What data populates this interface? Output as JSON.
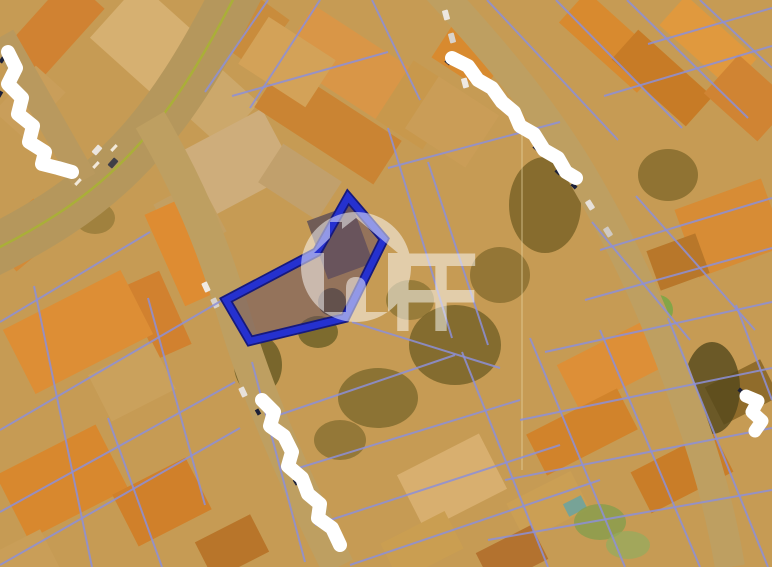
{
  "map": {
    "title": "aerial-cadastral-parcel-view",
    "canvas": {
      "width": 772,
      "height": 567
    },
    "colors": {
      "base": "#c49d58",
      "haze": "#e08a28",
      "parcel_line": "#8d90d8",
      "road": "#b79c64",
      "road_centerline": "#a6b23a",
      "highlight_stroke": "#2531cf",
      "highlight_underlay": "#16197d",
      "highlight_fill": "rgba(98,76,98,0.5)",
      "redaction": "#ffffff",
      "redaction_text_fragment": "#1c2038",
      "watermark": "#ffffff"
    },
    "roads": [
      {
        "name": "arterial-nw",
        "d": "M 240,-14 C 205,55 170,115 122,162 C 82,202 35,230 -14,254",
        "width": 50,
        "color": "#b29860",
        "centerline": true
      },
      {
        "name": "side-road-west",
        "d": "M 2,36 L 84,180",
        "width": 26,
        "color": "#b69a62",
        "centerline": false
      },
      {
        "name": "street-southwest",
        "d": "M 150,120 C 188,185 212,242 233,312 C 256,390 292,475 338,567",
        "width": 33,
        "color": "#bca166",
        "centerline": false
      },
      {
        "name": "street-northeast",
        "d": "M 438,-10 C 498,55 548,115 588,185 C 632,262 662,330 690,415 C 710,470 722,520 730,567",
        "width": 30,
        "color": "#bca166",
        "centerline": false
      }
    ],
    "road_marks": [
      [
        78,
        182
      ],
      [
        96,
        165
      ],
      [
        114,
        148
      ]
    ],
    "blocks": [
      [
        55,
        28,
        95,
        48,
        -48,
        "#cf8233"
      ],
      [
        30,
        102,
        62,
        40,
        -48,
        "#c8a05e"
      ],
      [
        150,
        42,
        74,
        95,
        -48,
        "#d6b377"
      ],
      [
        208,
        96,
        58,
        85,
        -48,
        "#cbaa70"
      ],
      [
        25,
        235,
        60,
        45,
        -40,
        "#d28a38"
      ],
      [
        238,
        162,
        92,
        72,
        -28,
        "#cdb082"
      ],
      [
        190,
        218,
        52,
        58,
        -28,
        "#c1a167"
      ],
      [
        184,
        252,
        42,
        100,
        -24,
        "#de8c33"
      ],
      [
        158,
        315,
        38,
        80,
        -24,
        "#d08130"
      ],
      [
        255,
        32,
        60,
        42,
        -54,
        "#c88c3e"
      ],
      [
        360,
        72,
        150,
        62,
        33,
        "#d9974a"
      ],
      [
        328,
        124,
        142,
        52,
        33,
        "#c98434"
      ],
      [
        287,
        62,
        80,
        56,
        33,
        "#d2a45c"
      ],
      [
        300,
        182,
        70,
        46,
        33,
        "#bfa271"
      ],
      [
        418,
        105,
        56,
        70,
        33,
        "#c6994f"
      ],
      [
        452,
        122,
        72,
        62,
        33,
        "#c99f5b"
      ],
      [
        470,
        55,
        62,
        46,
        33,
        "#d88a30"
      ],
      [
        612,
        42,
        42,
        105,
        -48,
        "#d88a30"
      ],
      [
        662,
        78,
        40,
        100,
        -48,
        "#c57a26"
      ],
      [
        708,
        42,
        40,
        95,
        -48,
        "#e09a40"
      ],
      [
        748,
        98,
        52,
        72,
        -48,
        "#cf8434"
      ],
      [
        730,
        228,
        92,
        72,
        -20,
        "#d78c36"
      ],
      [
        678,
        262,
        52,
        42,
        -20,
        "#b5762a"
      ],
      [
        618,
        362,
        112,
        50,
        -27,
        "#dd9038"
      ],
      [
        582,
        432,
        102,
        46,
        -27,
        "#d0832c"
      ],
      [
        682,
        472,
        92,
        46,
        -27,
        "#c77c28"
      ],
      [
        742,
        392,
        62,
        42,
        -27,
        "#8a6a2c"
      ],
      [
        548,
        506,
        72,
        42,
        -27,
        "#caa158"
      ],
      [
        452,
        482,
        92,
        62,
        -27,
        "#d8b275"
      ],
      [
        422,
        546,
        72,
        42,
        -27,
        "#c9a054"
      ],
      [
        512,
        556,
        62,
        38,
        -27,
        "#b07030"
      ],
      [
        78,
        332,
        132,
        72,
        -27,
        "#dd8e36"
      ],
      [
        132,
        382,
        72,
        52,
        -27,
        "#c9a360"
      ],
      [
        62,
        482,
        112,
        72,
        -27,
        "#d8882f"
      ],
      [
        162,
        502,
        82,
        58,
        -27,
        "#cf7f2b"
      ],
      [
        232,
        547,
        62,
        42,
        -27,
        "#b5742a"
      ],
      [
        22,
        562,
        62,
        42,
        -27,
        "#c8a05c"
      ],
      [
        575,
        506,
        20,
        14,
        -27,
        "#6fa5a0"
      ]
    ],
    "vegetation": [
      [
        545,
        205,
        36,
        48,
        "#6b5a22",
        0.75
      ],
      [
        500,
        275,
        30,
        28,
        "#6b5a22",
        0.6
      ],
      [
        455,
        345,
        46,
        40,
        "#5f5420",
        0.7
      ],
      [
        378,
        398,
        40,
        30,
        "#665a24",
        0.65
      ],
      [
        658,
        310,
        15,
        15,
        "#79a84a",
        0.95
      ],
      [
        712,
        388,
        28,
        46,
        "#4a431c",
        0.8
      ],
      [
        668,
        175,
        30,
        26,
        "#6b5a22",
        0.65
      ],
      [
        258,
        365,
        24,
        30,
        "#57511f",
        0.75
      ],
      [
        318,
        332,
        20,
        16,
        "#56531e",
        0.7
      ],
      [
        95,
        218,
        20,
        16,
        "#7a6a2e",
        0.55
      ],
      [
        600,
        522,
        26,
        18,
        "#7fa050",
        0.8
      ],
      [
        628,
        545,
        22,
        14,
        "#8fae62",
        0.7
      ],
      [
        340,
        440,
        26,
        20,
        "#6b5e26",
        0.6
      ],
      [
        410,
        300,
        24,
        20,
        "#6b5e26",
        0.55
      ]
    ],
    "cars": [
      [
        97,
        150,
        -48,
        "#ececec"
      ],
      [
        113,
        163,
        -48,
        "#343a4a"
      ],
      [
        206,
        287,
        65,
        "#f2f2f2"
      ],
      [
        215,
        303,
        65,
        "#d8d8d8"
      ],
      [
        243,
        392,
        65,
        "#e8e8e8"
      ],
      [
        558,
        158,
        58,
        "#f0f0f0"
      ],
      [
        572,
        176,
        58,
        "#2e3440"
      ],
      [
        590,
        205,
        58,
        "#e8e8e8"
      ],
      [
        608,
        232,
        58,
        "#cfcfcf"
      ],
      [
        446,
        15,
        75,
        "#eeeeee"
      ],
      [
        452,
        38,
        75,
        "#d9d9d9"
      ],
      [
        459,
        61,
        75,
        "#3a4050"
      ],
      [
        465,
        83,
        75,
        "#f0f0f0"
      ]
    ],
    "parcel_lines": [
      [
        320,
        0,
        250,
        108
      ],
      [
        268,
        0,
        205,
        92
      ],
      [
        372,
        0,
        420,
        100
      ],
      [
        388,
        128,
        452,
        338
      ],
      [
        428,
        162,
        488,
        345
      ],
      [
        487,
        0,
        618,
        140
      ],
      [
        556,
        0,
        682,
        128
      ],
      [
        627,
        0,
        748,
        118
      ],
      [
        700,
        0,
        772,
        68
      ],
      [
        592,
        222,
        690,
        340
      ],
      [
        636,
        196,
        755,
        330
      ],
      [
        462,
        352,
        548,
        567
      ],
      [
        530,
        338,
        625,
        567
      ],
      [
        600,
        330,
        700,
        567
      ],
      [
        668,
        318,
        768,
        567
      ],
      [
        736,
        305,
        772,
        400
      ],
      [
        34,
        286,
        92,
        567
      ],
      [
        108,
        418,
        162,
        567
      ],
      [
        252,
        362,
        305,
        562
      ],
      [
        148,
        298,
        205,
        505
      ],
      [
        0,
        322,
        150,
        232
      ],
      [
        0,
        430,
        226,
        298
      ],
      [
        0,
        512,
        235,
        382
      ],
      [
        0,
        565,
        240,
        428
      ],
      [
        270,
        418,
        455,
        355
      ],
      [
        292,
        470,
        520,
        400
      ],
      [
        315,
        525,
        560,
        445
      ],
      [
        350,
        565,
        600,
        480
      ],
      [
        352,
        322,
        500,
        368
      ],
      [
        388,
        168,
        560,
        122
      ],
      [
        232,
        96,
        388,
        52
      ],
      [
        604,
        96,
        772,
        46
      ],
      [
        648,
        44,
        772,
        8
      ],
      [
        600,
        250,
        772,
        198
      ],
      [
        585,
        300,
        772,
        248
      ],
      [
        545,
        352,
        772,
        302
      ],
      [
        520,
        420,
        772,
        368
      ],
      [
        505,
        480,
        772,
        428
      ],
      [
        488,
        540,
        772,
        490
      ]
    ],
    "seam": {
      "x": 522,
      "y1": 118,
      "y2": 470
    },
    "highlight": {
      "vertices": [
        [
          348,
          197
        ],
        [
          384,
          239
        ],
        [
          345,
          318
        ],
        [
          250,
          341
        ],
        [
          226,
          300
        ],
        [
          317,
          252
        ]
      ],
      "inner_roof": [
        340,
        242,
        48,
        62,
        -20,
        "#5a4c56"
      ],
      "inner_tree": [
        332,
        302,
        14,
        "#4c4630"
      ]
    },
    "redactions": [
      {
        "name": "street-label-redacted-nw",
        "d": "M 8,52 L 16,68 L 8,84 L 22,98 L 18,114 L 33,126 L 29,142 L 45,152 L 42,164 L 58,168 L 72,172",
        "width": 14,
        "fragments": [
          [
            2,
            60,
            -55
          ],
          [
            0,
            94,
            -60
          ],
          [
            26,
            138,
            -50
          ],
          [
            50,
            166,
            -20
          ]
        ]
      },
      {
        "name": "street-label-redacted-ne",
        "d": "M 452,58 L 468,66 L 478,80 L 492,88 L 502,102 L 514,112 L 520,126 L 534,134 L 544,150 L 558,158 L 566,172 L 576,178",
        "width": 14,
        "fragments": [
          [
            448,
            62,
            40
          ],
          [
            536,
            148,
            42
          ],
          [
            558,
            172,
            44
          ],
          [
            574,
            186,
            45
          ]
        ]
      },
      {
        "name": "street-label-redacted-s",
        "d": "M 262,400 L 274,412 L 270,426 L 284,436 L 292,452 L 288,466 L 302,478 L 308,494 L 320,504 L 318,518 L 332,528 L 340,545",
        "width": 14,
        "fragments": [
          [
            258,
            412,
            60
          ],
          [
            296,
            482,
            58
          ],
          [
            318,
            520,
            60
          ],
          [
            336,
            542,
            55
          ]
        ]
      },
      {
        "name": "street-label-redacted-e",
        "d": "M 746,396 L 758,401 L 752,412 L 762,421 L 755,431",
        "width": 13,
        "fragments": [
          [
            741,
            391,
            40
          ]
        ]
      }
    ],
    "watermark": {
      "letters": "FF",
      "opacity": 0.5,
      "cx": 356,
      "cy": 267,
      "r": 55
    }
  }
}
